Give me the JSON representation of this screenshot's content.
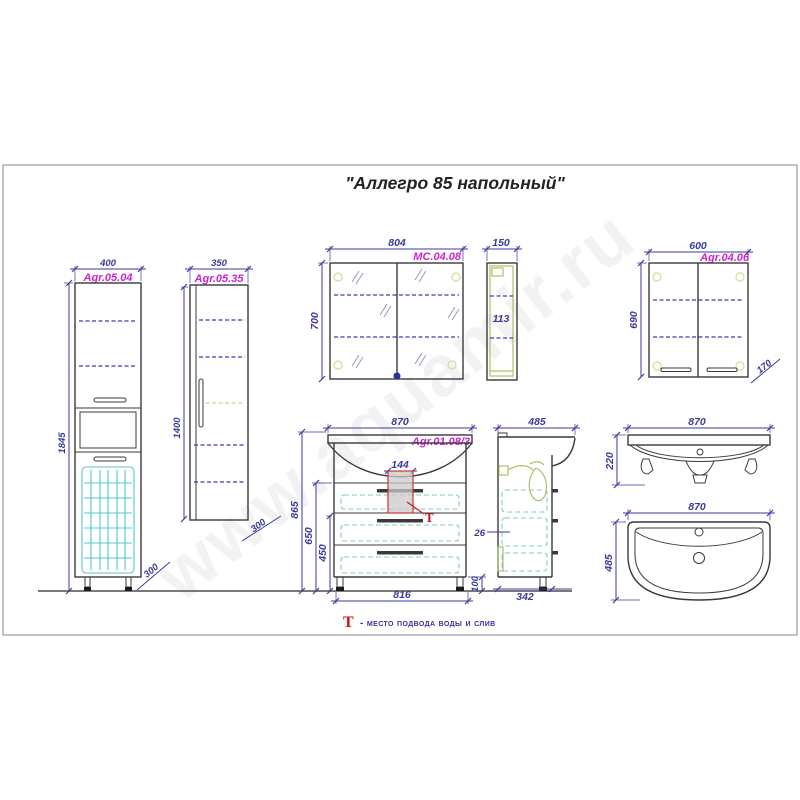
{
  "title": "\"Аллегро 85 напольный\"",
  "watermark": "www.aquamir.ru",
  "legend": {
    "symbol": "Т",
    "text": "- место подвода воды и слив"
  },
  "colors": {
    "dimension_blue": "#3a3a9c",
    "product_label_magenta": "#cc22cc",
    "outline_dark": "#3a3a3a",
    "shelf_dashed_blue": "#3b3bac",
    "basket_cyan": "#55c8c8",
    "drawer_dashed_cyan": "#7ecaca",
    "plumbing_green": "#a9c26a",
    "marker_red": "#cc2222",
    "frame_gray": "#adadad"
  },
  "views": {
    "tall_cabinet": {
      "code": "Agr.05.04",
      "width": "400",
      "height": "1845",
      "depth": "300"
    },
    "column_cabinet": {
      "code": "Agr.05.35",
      "width": "350",
      "height": "1400",
      "depth": "300"
    },
    "mirror_front": {
      "code": "МС.04.08",
      "width": "804",
      "height": "700"
    },
    "mirror_side": {
      "width": "150",
      "inner_height": "113"
    },
    "wall_cabinet": {
      "code": "Agr.04.06",
      "width": "600",
      "height": "690",
      "depth": "170"
    },
    "vanity_front": {
      "code": "Agr.01.08/3",
      "width": "870",
      "height": "865",
      "drawers_height": "650",
      "lower_height": "450",
      "siphon_width": "144",
      "base_width": "816",
      "leg_height": "100",
      "marker": "Т"
    },
    "vanity_side": {
      "depth": "485",
      "base_depth": "342",
      "gap": "26"
    },
    "sink_front": {
      "width": "870",
      "height": "220"
    },
    "sink_plan": {
      "width": "870",
      "depth": "485"
    }
  }
}
